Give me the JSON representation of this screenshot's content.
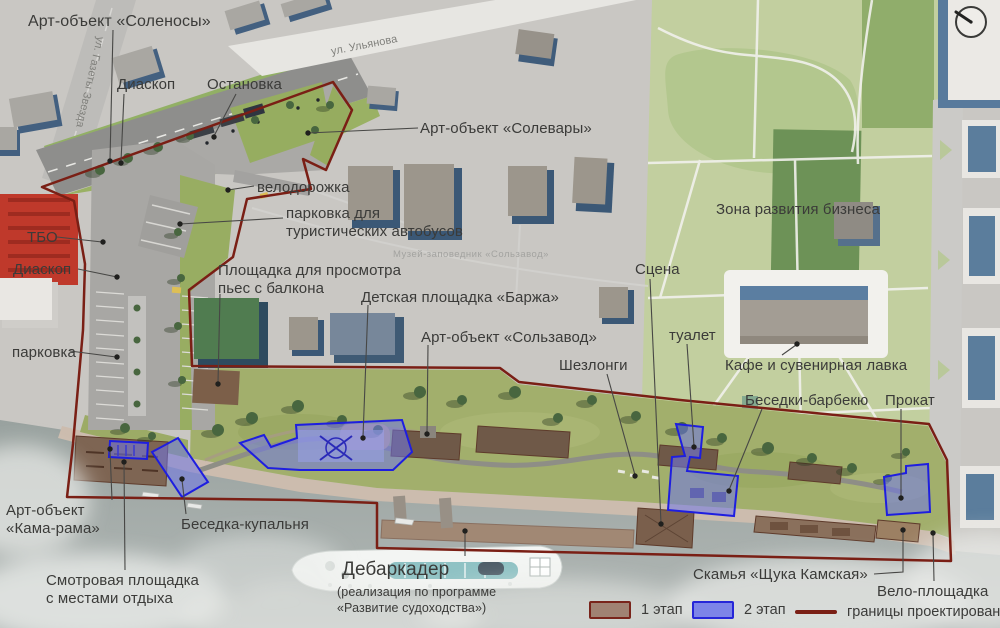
{
  "labels": {
    "art_solenosy": "Арт-объект «Соленосы»",
    "diaskop_top": "Диаскоп",
    "ostanovka": "Остановка",
    "art_solevary": "Арт-объект «Солевары»",
    "velodorozhka": "велодорожка",
    "parkovka_bus_l1": "парковка для",
    "parkovka_bus_l2": "туристических автобусов",
    "tbo": "ТБО",
    "diaskop_left": "Диаскоп",
    "parkovka": "парковка",
    "ploshchadka_l1": "Площадка для просмотра",
    "ploshchadka_l2": "пьес с балкона",
    "detskaya": "Детская площадка «Баржа»",
    "art_solzavod": "Арт-объект «Сользавод»",
    "scena": "Сцена",
    "tualet": "туалет",
    "zona_biznesa": "Зона развития бизнеса",
    "kafe": "Кафе и сувенирная лавка",
    "shezlongi": "Шезлонги",
    "besedki_barbekyu": "Беседки-барбекю",
    "prokat": "Прокат",
    "kamarama_l1": "Арт-объект",
    "kamarama_l2": "«Кама-рама»",
    "besedka_kupalnya": "Беседка-купальня",
    "smotrovaya_l1": "Смотровая площадка",
    "smotrovaya_l2": "с местами отдыха",
    "debarkader": "Дебаркадер",
    "debarkader_sub1": "(реализация по программе",
    "debarkader_sub2": "«Развитие судоходства»)",
    "skamya": "Скамья «Щука Камская»",
    "velo_ploshchadka": "Вело-площадка"
  },
  "streets": {
    "ulyanova": "ул. Ульянова",
    "gazety_zvezda": "ул. Газеты Звезда"
  },
  "watermark": "Музей-заповедник «Сользавод»",
  "legend": {
    "stage1_label": "1 этап",
    "stage1_color": "#a08273",
    "stage1_border": "#79241b",
    "stage2_label": "2 этап",
    "stage2_color": "#7d84e8",
    "stage2_border": "#2626d8",
    "boundary_label": "границы проектирования",
    "boundary_color": "#7a1f15"
  }
}
